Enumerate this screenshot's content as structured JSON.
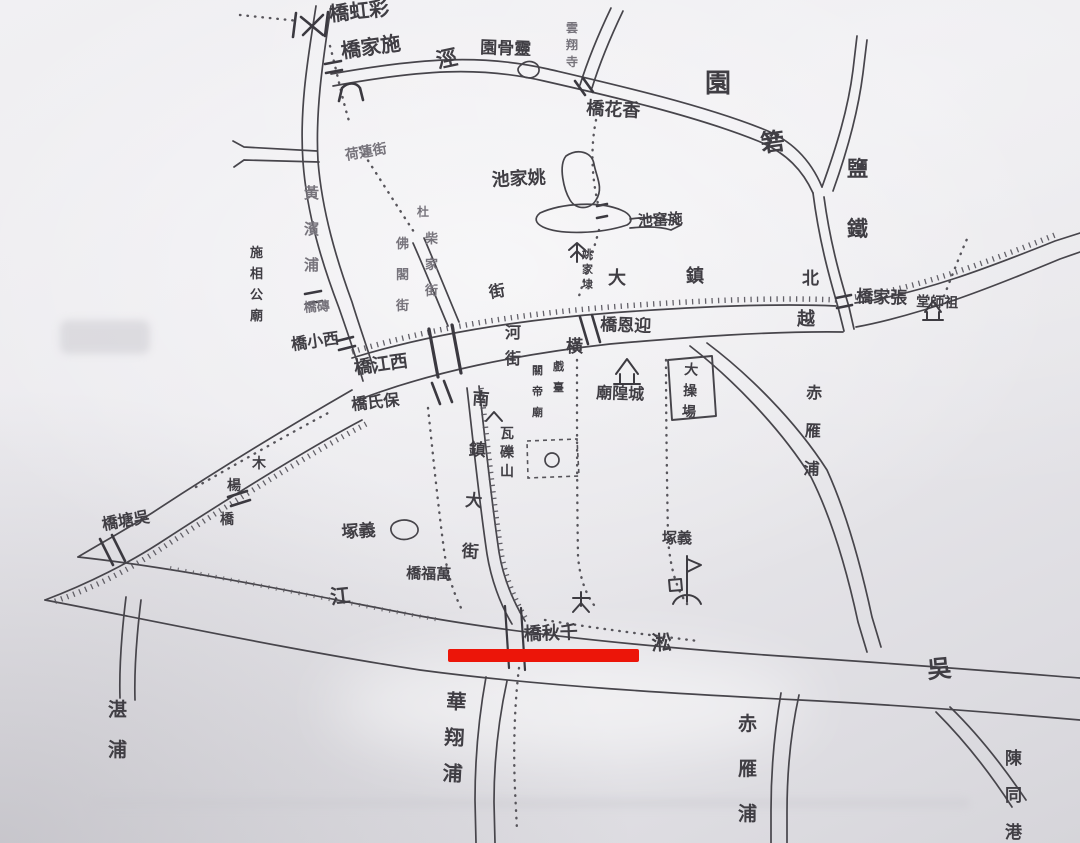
{
  "map": {
    "description_visible": "hand-drawn ink town map photograph",
    "ink_color": "#403e44",
    "mid_color": "#77747c",
    "faded_color": "#9a97a0",
    "annotation": {
      "label": "red-underline",
      "color": "#ec1509"
    },
    "labels": [
      {
        "id": "caihong-bridge",
        "text": "橋虹彩",
        "x": 330,
        "y": 21,
        "size": 20,
        "rot": -6
      },
      {
        "id": "shijia-bridge",
        "text": "橋家施",
        "x": 342,
        "y": 58,
        "size": 20,
        "rot": -8
      },
      {
        "id": "jing-stream",
        "text": "涇",
        "x": 438,
        "y": 68,
        "size": 21,
        "rot": -12
      },
      {
        "id": "linggu-yuan",
        "text": "園骨靈",
        "x": 480,
        "y": 53,
        "size": 17,
        "rot": 2
      },
      {
        "id": "yunxiang-temple",
        "text": "雲翔寺",
        "x": 566,
        "y": 32,
        "size": 12,
        "vertical": true,
        "gap": 17,
        "tone": "mid"
      },
      {
        "id": "xianghua-bridge",
        "text": "橋花香",
        "x": 586,
        "y": 114,
        "size": 18,
        "rot": 3
      },
      {
        "id": "yuan-garden",
        "text": "園",
        "x": 705,
        "y": 92,
        "size": 26
      },
      {
        "id": "ruo",
        "text": "箬",
        "x": 762,
        "y": 152,
        "size": 24,
        "rot": -8
      },
      {
        "id": "yantie-canal",
        "text": "鹽鐵",
        "x": 847,
        "y": 176,
        "size": 21,
        "vertical": true,
        "gap": 60
      },
      {
        "id": "zhangjia-bridge",
        "text": "橋家張",
        "x": 856,
        "y": 302,
        "size": 17,
        "rot": 2
      },
      {
        "id": "zushi-hall",
        "text": "堂師祖",
        "x": 916,
        "y": 306,
        "size": 14,
        "rot": 2
      },
      {
        "id": "road-char-bei",
        "text": "北",
        "x": 802,
        "y": 284,
        "size": 17
      },
      {
        "id": "road-char-zhen",
        "text": "鎮",
        "x": 686,
        "y": 282,
        "size": 18
      },
      {
        "id": "road-char-da",
        "text": "大",
        "x": 608,
        "y": 284,
        "size": 18
      },
      {
        "id": "road-char-jie",
        "text": "街",
        "x": 490,
        "y": 298,
        "size": 16,
        "rot": -10
      },
      {
        "id": "yue",
        "text": "越",
        "x": 797,
        "y": 325,
        "size": 18
      },
      {
        "id": "yingen-bridge",
        "text": "橋恩迎",
        "x": 600,
        "y": 330,
        "size": 17,
        "rot": 2
      },
      {
        "id": "yaojiadai",
        "text": "姚家埭",
        "x": 582,
        "y": 258,
        "size": 11,
        "vertical": true,
        "gap": 15
      },
      {
        "id": "yaojia-pond",
        "text": "池家姚",
        "x": 492,
        "y": 186,
        "size": 18,
        "rot": -3
      },
      {
        "id": "shiyao-pond",
        "text": "池窰施",
        "x": 638,
        "y": 226,
        "size": 15,
        "rot": -3
      },
      {
        "id": "huangbin-pu",
        "text": "黃濱浦",
        "x": 304,
        "y": 198,
        "size": 15,
        "vertical": true,
        "gap": 36,
        "tone": "mid"
      },
      {
        "id": "zhuan-bridge",
        "text": "橋磚",
        "x": 304,
        "y": 312,
        "size": 13,
        "rot": -4,
        "tone": "mid"
      },
      {
        "id": "shixianggong-miao",
        "text": "施相公廟",
        "x": 250,
        "y": 257,
        "size": 13,
        "vertical": true,
        "gap": 21
      },
      {
        "id": "xixiao-bridge",
        "text": "橋小西",
        "x": 292,
        "y": 350,
        "size": 16,
        "rot": -8
      },
      {
        "id": "xijiang-bridge",
        "text": "橋江西",
        "x": 355,
        "y": 374,
        "size": 18,
        "rot": -8
      },
      {
        "id": "he-jie",
        "text": "河街",
        "x": 505,
        "y": 338,
        "size": 16,
        "vertical": true,
        "gap": 26
      },
      {
        "id": "heng",
        "text": "橫",
        "x": 566,
        "y": 352,
        "size": 17
      },
      {
        "id": "baoshi-bridge",
        "text": "橋氏保",
        "x": 352,
        "y": 410,
        "size": 16,
        "rot": -6
      },
      {
        "id": "nanzhen-dajie",
        "text": "南鎮大街",
        "x": 472,
        "y": 404,
        "size": 17,
        "vertical": true,
        "gap": 51,
        "rot": 4
      },
      {
        "id": "du",
        "text": "杜",
        "x": 417,
        "y": 216,
        "size": 12,
        "tone": "mid"
      },
      {
        "id": "chaijia-street",
        "text": "柴家街",
        "x": 425,
        "y": 243,
        "size": 13,
        "vertical": true,
        "gap": 26,
        "tone": "mid"
      },
      {
        "id": "foge-street",
        "text": "佛閣街",
        "x": 396,
        "y": 248,
        "size": 13,
        "vertical": true,
        "gap": 31,
        "tone": "mid"
      },
      {
        "id": "helian-street",
        "text": "荷蓮街",
        "x": 346,
        "y": 160,
        "size": 14,
        "rot": -10,
        "tone": "mid"
      },
      {
        "id": "walishan",
        "text": "瓦礫山",
        "x": 500,
        "y": 438,
        "size": 14,
        "vertical": true,
        "gap": 19
      },
      {
        "id": "yizhong-left",
        "text": "塚義",
        "x": 342,
        "y": 538,
        "size": 17,
        "rot": -4
      },
      {
        "id": "yizhong-right",
        "text": "塚義",
        "x": 662,
        "y": 543,
        "size": 15
      },
      {
        "id": "wanfu-bridge",
        "text": "橋福萬",
        "x": 406,
        "y": 578,
        "size": 15,
        "rot": 2
      },
      {
        "id": "jiang",
        "text": "江",
        "x": 331,
        "y": 604,
        "size": 20,
        "rot": -6
      },
      {
        "id": "song",
        "text": "淞",
        "x": 652,
        "y": 650,
        "size": 20,
        "rot": -3
      },
      {
        "id": "wu",
        "text": "吳",
        "x": 928,
        "y": 678,
        "size": 24,
        "rot": -5
      },
      {
        "id": "qianqiu-bridge",
        "text": "橋秋千",
        "x": 524,
        "y": 640,
        "size": 18,
        "rot": -2
      },
      {
        "id": "huaxiang-pu",
        "text": "華翔浦",
        "x": 446,
        "y": 708,
        "size": 20,
        "vertical": true,
        "gap": 36,
        "rot": 3
      },
      {
        "id": "zhan-pu",
        "text": "湛浦",
        "x": 108,
        "y": 716,
        "size": 19,
        "vertical": true,
        "gap": 40
      },
      {
        "id": "chiyan-pu-mid",
        "text": "赤雁浦",
        "x": 806,
        "y": 398,
        "size": 16,
        "vertical": true,
        "gap": 38,
        "rot": 2
      },
      {
        "id": "chiyan-pu-south",
        "text": "赤雁浦",
        "x": 738,
        "y": 730,
        "size": 19,
        "vertical": true,
        "gap": 45
      },
      {
        "id": "chentong-gang",
        "text": "陳同港",
        "x": 1005,
        "y": 764,
        "size": 17,
        "vertical": true,
        "gap": 37
      },
      {
        "id": "wutang-bridge",
        "text": "橋塘吳",
        "x": 103,
        "y": 530,
        "size": 16,
        "rot": -10
      },
      {
        "id": "mu-char",
        "text": "木",
        "x": 252,
        "y": 468,
        "size": 14
      },
      {
        "id": "yang-char",
        "text": "楊",
        "x": 227,
        "y": 490,
        "size": 14
      },
      {
        "id": "qiao-char",
        "text": "橋",
        "x": 220,
        "y": 524,
        "size": 14
      },
      {
        "id": "xitai",
        "text": "戲臺",
        "x": 553,
        "y": 370,
        "size": 11,
        "vertical": true,
        "gap": 21
      },
      {
        "id": "guandi-miao",
        "text": "關帝廟",
        "x": 532,
        "y": 374,
        "size": 11,
        "vertical": true,
        "gap": 21
      },
      {
        "id": "chenghuang-miao",
        "text": "廟隍城",
        "x": 596,
        "y": 398,
        "size": 16,
        "rot": 2
      },
      {
        "id": "dacaochang",
        "text": "大操場",
        "x": 684,
        "y": 374,
        "size": 14,
        "vertical": true,
        "gap": 21,
        "rot": 3
      }
    ]
  }
}
